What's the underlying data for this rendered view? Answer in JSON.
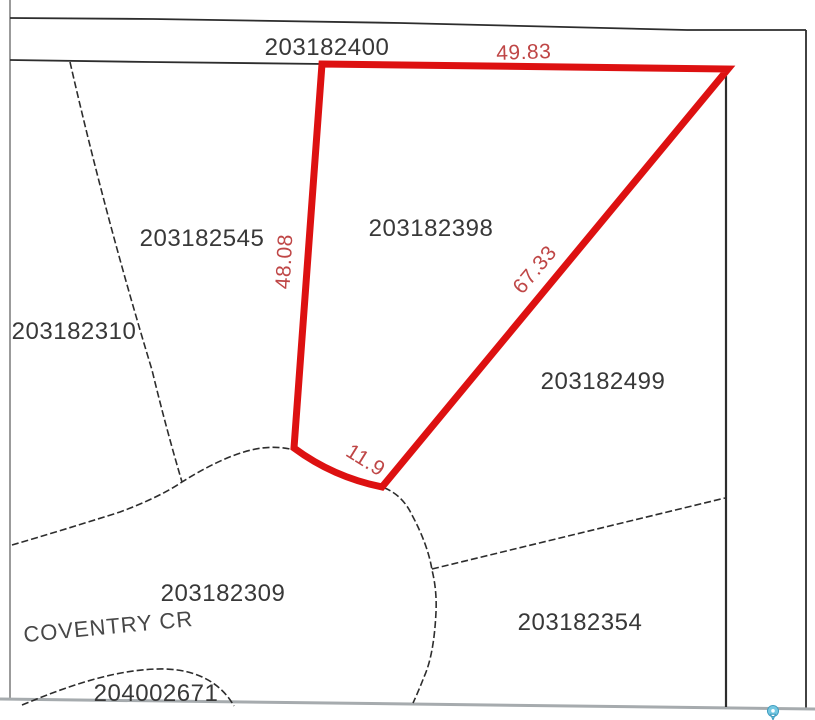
{
  "colors": {
    "highlight_red": "#dd1111",
    "dimension_label_red": "#bf4646",
    "parcel_label_gray": "#383838",
    "boundary_black": "#2d2d2d",
    "border_gray": "#a6abae",
    "pin_blue": "#74c8e2"
  },
  "street": {
    "label": "COVENTRY CR"
  },
  "parcels": [
    {
      "id": "203182400"
    },
    {
      "id": "203182545"
    },
    {
      "id": "203182310"
    },
    {
      "id": "203182398",
      "highlighted": true
    },
    {
      "id": "203182499"
    },
    {
      "id": "203182309"
    },
    {
      "id": "204002671"
    },
    {
      "id": "203182354"
    }
  ],
  "highlight": {
    "parcel_id": "203182398",
    "dimensions": [
      {
        "side": "north",
        "value": "49.83"
      },
      {
        "side": "west",
        "value": "48.08"
      },
      {
        "side": "southeast",
        "value": "67.33"
      },
      {
        "side": "south",
        "value": "11.9"
      }
    ]
  },
  "icons": [
    {
      "name": "map-pin-icon"
    }
  ]
}
